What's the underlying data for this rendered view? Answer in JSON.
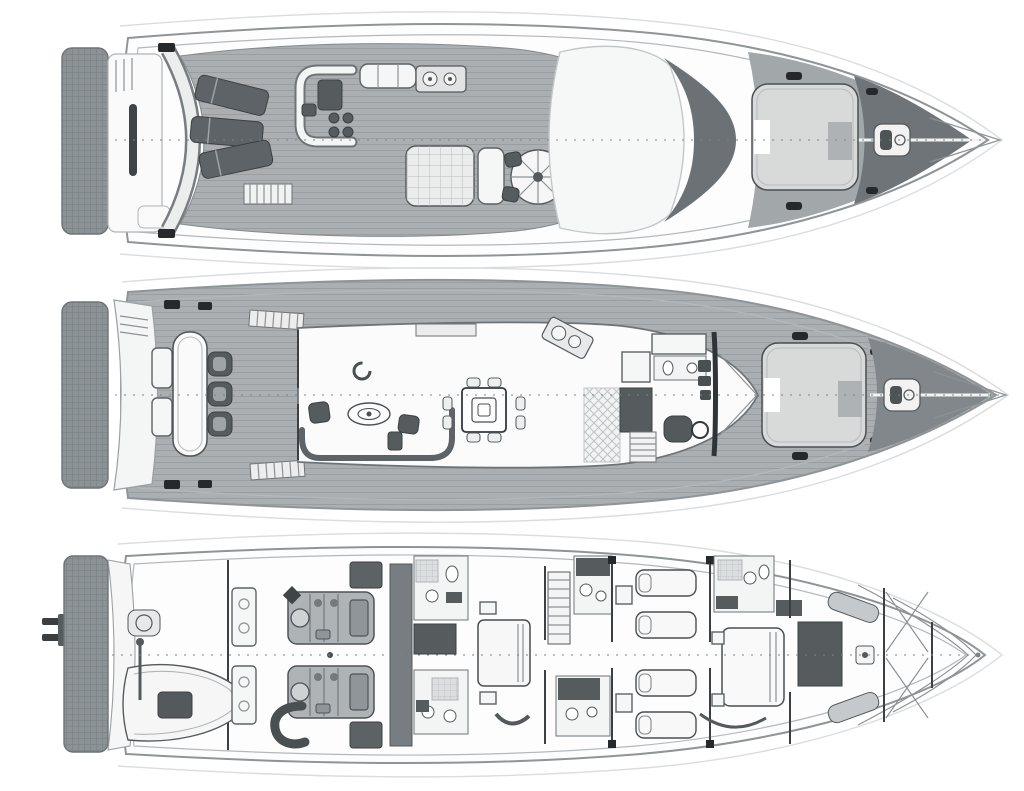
{
  "image": {
    "label": "Yacht general arrangement plan - three deck top views stacked vertically, bow pointing right",
    "background": "#ffffff"
  },
  "palette": {
    "paper": "#ffffff",
    "hull_line": "#8f9497",
    "teak_deck": "#abafb2",
    "side_deck": "#b2b6b8",
    "dark_fixture": "#565b5e",
    "windscreen_dark": "#6b7174",
    "sun_pad": "#d8dada",
    "swim_platform": "#8c9295",
    "ink": "#4a4f52"
  },
  "decks": [
    {
      "id": "flybridge-deck",
      "label": "Flybridge sun deck (top plan)",
      "features": [
        "swim platform",
        "transom steps",
        "radar arch",
        "three sun loungers",
        "companionway stairs",
        "C-shaped settee with table and stools",
        "bench seat",
        "wet bar with twin sinks",
        "gridded sun pad",
        "round table with curved bench",
        "white hardtop brow",
        "dark windscreen crescent",
        "foredeck sun pad",
        "anchor windlass",
        "bow pulpit"
      ]
    },
    {
      "id": "main-deck",
      "label": "Main deck (middle plan)",
      "features": [
        "swim platform",
        "transom stairs",
        "aft deck table with three chairs",
        "side stairs to flybridge",
        "salon L-sofa",
        "armchair",
        "oval coffee table",
        "side chairs",
        "dining table with eight chairs",
        "sideboard",
        "galley with angled cooktop",
        "tiled galley sole",
        "stairs down",
        "day head",
        "helm station with dashboard and seat",
        "windscreen",
        "foredeck sun pad",
        "anchor windlass",
        "bow pulpit"
      ]
    },
    {
      "id": "lower-deck",
      "label": "Lower deck (bottom plan)",
      "features": [
        "stern ladder",
        "hatched transom platform",
        "tender garage with RIB tender",
        "liferaft canister",
        "davit crane",
        "engine room with twin engines",
        "sea strainer",
        "exhaust muffler",
        "intake plenums",
        "fuel tank bulkhead",
        "midship cabin with double bed",
        "port en-suite bathroom",
        "starboard en-suite bathroom",
        "wardrobes",
        "staircase lobby",
        "guest bathrooms",
        "two twin guest cabins",
        "VIP bathroom",
        "forward double-bed cabin",
        "angled crew berths",
        "chain locker with cross bracing"
      ]
    }
  ]
}
